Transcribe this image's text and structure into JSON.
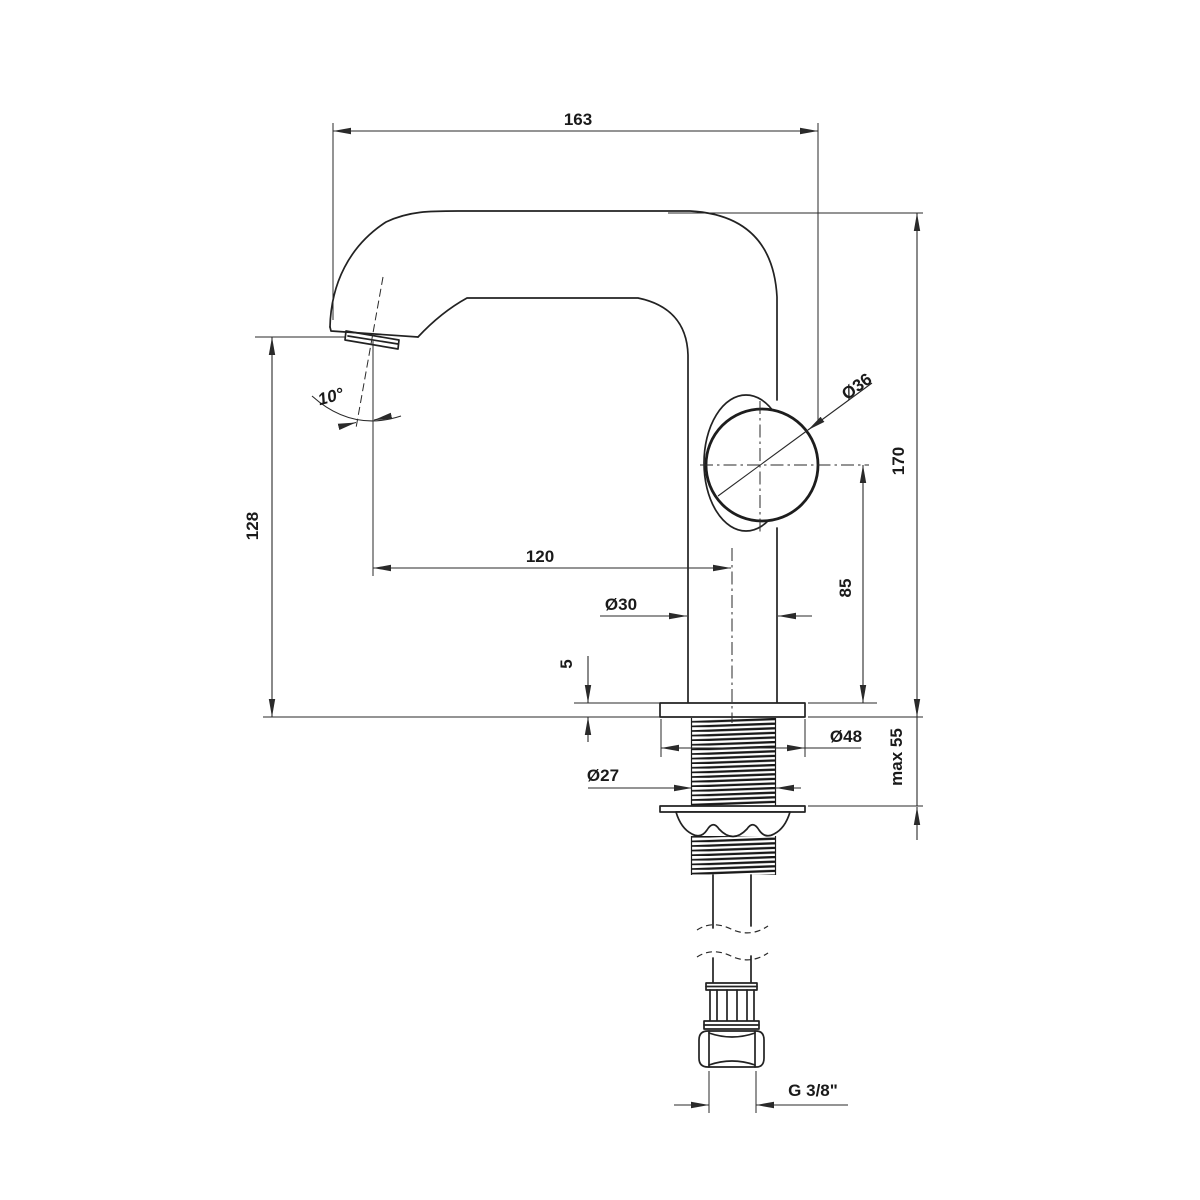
{
  "drawing": {
    "background": "#ffffff",
    "line_color": "#222222",
    "dimensions": {
      "spout_reach": "163",
      "overall_height": "170",
      "outlet_height": "128",
      "spout_projection": "120",
      "handle_center_height": "85",
      "handle_diameter": "Ø36",
      "body_diameter": "Ø30",
      "base_plate_thickness": "5",
      "base_plate_diameter": "Ø48",
      "shank_thread_diameter": "Ø27",
      "max_mounting_thickness": "max 55",
      "outlet_angle": "10°",
      "supply_connection": "G 3/8\""
    }
  }
}
